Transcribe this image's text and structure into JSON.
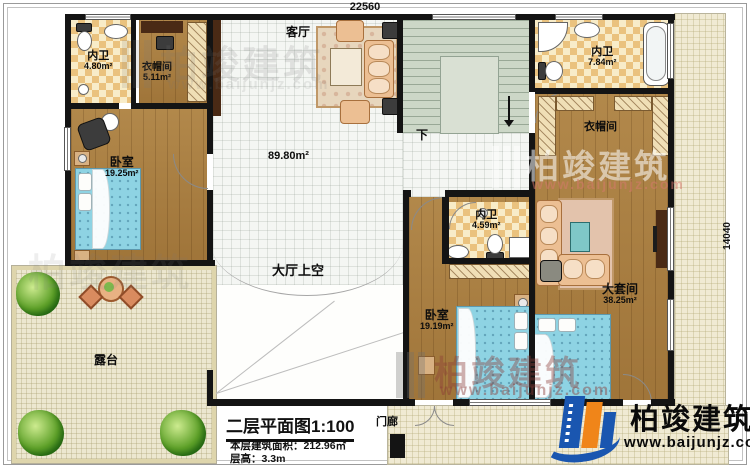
{
  "dimensions": {
    "top_width": "22560",
    "right_height": "14040"
  },
  "rooms": {
    "bath1": {
      "label": "内卫",
      "area": "4.80m²"
    },
    "closet1": {
      "label": "衣帽间",
      "area": "5.11m²"
    },
    "bedroom1": {
      "label": "卧室",
      "area": "19.25m²"
    },
    "living": {
      "label": "客厅"
    },
    "hall": {
      "area": "89.80m²"
    },
    "bath2": {
      "label": "内卫",
      "area": "7.84m²"
    },
    "closet2": {
      "label": "衣帽间"
    },
    "bath3": {
      "label": "内卫",
      "area": "4.59m²"
    },
    "bedroom2": {
      "label": "卧室",
      "area": "19.19m²"
    },
    "master": {
      "label": "大套间",
      "area": "38.25m²"
    },
    "terrace": {
      "label": "露台"
    },
    "void": {
      "label": "大厅上空"
    },
    "porch": {
      "label": "门廊"
    },
    "stairs": {
      "label": "下"
    }
  },
  "title_block": {
    "title": "二层平面图1:100",
    "area_line": "本层建筑面积：212.96㎡",
    "floor_height_line": "层高：3.3m"
  },
  "brand": {
    "name": "柏竣建筑",
    "website": "www.baijunjz.com"
  },
  "watermark": {
    "name": "柏竣建筑",
    "website": "www.baijunjz.com"
  },
  "colors": {
    "wall": "#141414",
    "wood_floor": "#a97e40",
    "checker_tan": "#eac27e",
    "tile": "#f4f6f3",
    "stairs": "#ccd7c7",
    "terrace": "#ece7d0",
    "bed": "#8ed3e3",
    "sofa": "#ecbf93",
    "tree_green": "#4f9a25",
    "logo_blue": "#1a56b0",
    "logo_orange": "#f08519",
    "watermark_red": "#8c3c37"
  }
}
